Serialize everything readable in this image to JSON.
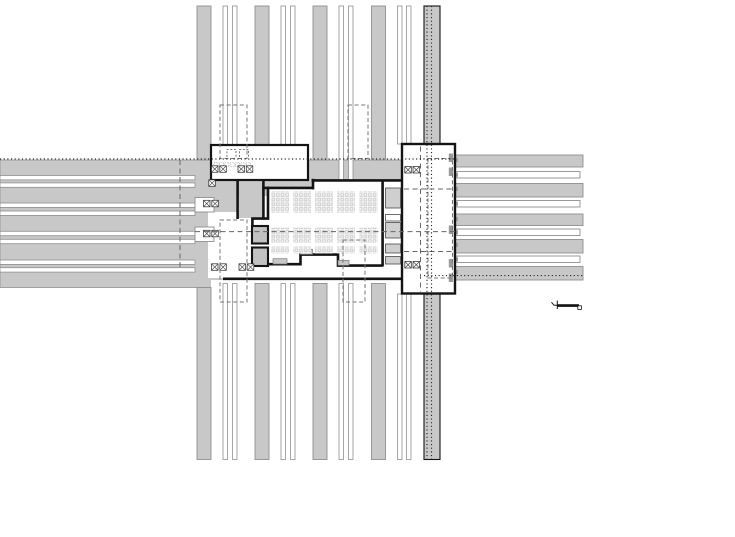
{
  "colors": {
    "road": "#c8c8c8",
    "edge": "#8f8f8f",
    "wall": "#141414",
    "dash": "#777777",
    "dot": "#262626",
    "shaft": "#c2c2c2",
    "paper": "#ffffff"
  },
  "plan": {
    "canvas": {
      "w": 735,
      "h": 537
    },
    "layers": [
      {
        "name": "horizontal-road-base",
        "cls": "flat",
        "rects": [
          [
            0,
            160,
            455,
            127.5
          ]
        ]
      },
      {
        "name": "under-building-clear",
        "cls": "white",
        "rects": [
          [
            211,
            280,
            244,
            8
          ]
        ]
      },
      {
        "name": "left-track-strips",
        "cls": "track",
        "rects": [
          [
            0,
            175.5,
            195,
            4.4
          ],
          [
            0,
            182.9,
            195,
            4.4
          ],
          [
            0,
            203,
            195,
            4.4
          ],
          [
            0,
            211,
            195,
            4.4
          ],
          [
            0,
            231.3,
            195,
            4.4
          ],
          [
            0,
            239.3,
            195,
            4.4
          ],
          [
            0,
            260,
            195,
            4.4
          ],
          [
            0,
            267.7,
            195,
            4.4
          ]
        ]
      },
      {
        "name": "right-road-bands",
        "cls": "road",
        "rects": [
          [
            455,
            155,
            128,
            12
          ],
          [
            455,
            183.5,
            128,
            13.5
          ],
          [
            455,
            214,
            128,
            11.5
          ],
          [
            455,
            239.5,
            128,
            13.5
          ],
          [
            455,
            266.5,
            128,
            13.5
          ]
        ]
      },
      {
        "name": "right-white-bars",
        "cls": "whitebar",
        "rects": [
          [
            457,
            171.5,
            123,
            6.5
          ],
          [
            457,
            200.5,
            123,
            6.5
          ],
          [
            457,
            229,
            123,
            6.5
          ],
          [
            457,
            256,
            123,
            6.5
          ]
        ]
      },
      {
        "name": "right-bar-ticks",
        "cls": "tick",
        "rects": [
          [
            455.8,
            173.2,
            2.2,
            3.2
          ],
          [
            455.8,
            202.2,
            2.2,
            3.2
          ],
          [
            455.8,
            230.7,
            2.2,
            3.2
          ],
          [
            455.8,
            257.7,
            2.2,
            3.2
          ],
          [
            456.2,
            158,
            1.6,
            4
          ],
          [
            456.2,
            187,
            1.6,
            4
          ],
          [
            456.2,
            217,
            1.6,
            4
          ],
          [
            456.2,
            243,
            1.6,
            4
          ],
          [
            456.2,
            270,
            1.6,
            4
          ]
        ]
      },
      {
        "name": "vertical-gray-bars-top",
        "cls": "road",
        "rects": [
          [
            197,
            6,
            14,
            154
          ],
          [
            255,
            6,
            14,
            154
          ],
          [
            313,
            6,
            14,
            154
          ],
          [
            371.5,
            6,
            14,
            154
          ]
        ]
      },
      {
        "name": "vertical-track-strips-top",
        "cls": "track",
        "rects": [
          [
            223,
            6,
            4.5,
            139
          ],
          [
            232.5,
            6,
            4.5,
            139
          ],
          [
            281,
            6,
            4.5,
            139
          ],
          [
            290.5,
            6,
            4.5,
            139
          ],
          [
            339,
            6,
            4.5,
            181
          ],
          [
            348.5,
            6,
            4.5,
            181
          ],
          [
            397.5,
            6,
            4.5,
            138
          ],
          [
            406.5,
            6,
            4.5,
            138
          ]
        ]
      },
      {
        "name": "vertical-gray-bars-bottom",
        "cls": "road",
        "rects": [
          [
            197,
            287.5,
            14,
            172
          ],
          [
            255,
            283.5,
            14,
            176
          ],
          [
            313,
            283.5,
            14,
            176
          ],
          [
            371.5,
            283.5,
            14,
            176
          ]
        ]
      },
      {
        "name": "vertical-track-strips-bottom",
        "cls": "track",
        "rects": [
          [
            223,
            283.5,
            4.5,
            176
          ],
          [
            232.5,
            283.5,
            4.5,
            176
          ],
          [
            281,
            283.5,
            4.5,
            176
          ],
          [
            290.5,
            283.5,
            4.5,
            176
          ],
          [
            339,
            283.5,
            4.5,
            176
          ],
          [
            348.5,
            283.5,
            4.5,
            176
          ],
          [
            397.5,
            294,
            4.5,
            165.5
          ],
          [
            406.5,
            294,
            4.5,
            165.5
          ]
        ]
      },
      {
        "name": "main-avenue-bar",
        "cls": "bigbar",
        "rects": [
          [
            424,
            6,
            16,
            138
          ],
          [
            424,
            294,
            16,
            165.5
          ]
        ]
      },
      {
        "name": "plaza-white",
        "cls": "white",
        "rects": [
          [
            208,
            212,
            60,
            66
          ],
          [
            238,
            196,
            30,
            22
          ]
        ]
      },
      {
        "name": "concourse-hall-floor",
        "paths": [
          [
            "M268,189 H313 V180 H402 V278 H268 Z",
            "white"
          ]
        ]
      },
      {
        "name": "corridor-gray",
        "cls": "flat2",
        "rects": [
          [
            239,
            180,
            23,
            38
          ]
        ]
      },
      {
        "name": "north-pavilion",
        "cls": "building",
        "rects": [
          [
            211,
            145,
            97,
            35
          ]
        ]
      },
      {
        "name": "east-wing",
        "cls": "building2",
        "rects": [
          [
            402,
            144,
            53,
            149.5
          ]
        ]
      },
      {
        "name": "walls",
        "paths": [
          [
            "M237.6,180 V219",
            "wall"
          ],
          [
            "M263.4,180 V219",
            "wall"
          ],
          [
            "M262,187.9 H313.5",
            "wall",
            3
          ],
          [
            "M311.5,180.4 H402",
            "wall",
            3
          ],
          [
            "M313,178.8 V189.4",
            "wall",
            2.8
          ],
          [
            "M382.6,180.5 V266.5",
            "wall",
            2.8
          ],
          [
            "M252,264.2 H300.5 V254.6 H338 V265.6 H382.6",
            "wall"
          ],
          [
            "M223,278.8 H402",
            "wall",
            3.2
          ],
          [
            "M268,186.5 V218.6 H252.4 V227.5",
            "wall"
          ]
        ]
      },
      {
        "name": "elevator-shafts",
        "cls": "shaft",
        "rects": [
          [
            252,
            226,
            16,
            17.5
          ],
          [
            252,
            247.5,
            16,
            18.5
          ]
        ]
      },
      {
        "name": "service-boxes",
        "rects": [
          [
            385.5,
            188,
            15,
            20,
            "box"
          ],
          [
            385.5,
            214.5,
            15,
            6.5,
            "boxw"
          ],
          [
            385.5,
            222.5,
            15,
            15.5,
            "box"
          ],
          [
            385.5,
            244,
            15,
            9,
            "box"
          ],
          [
            385.5,
            256.5,
            15,
            7.5,
            "box"
          ]
        ]
      },
      {
        "name": "platform-stubs",
        "cls": "graybit",
        "rects": [
          [
            273,
            258.7,
            14,
            5.3
          ],
          [
            300.5,
            249.3,
            12,
            5
          ],
          [
            338,
            260.3,
            11,
            5
          ],
          [
            368,
            193.8,
            8,
            6
          ]
        ]
      },
      {
        "name": "track-stubs-left",
        "cls": "whitebar",
        "rects": [
          [
            195,
            197.5,
            19,
            14.5
          ],
          [
            195,
            227,
            19,
            14.5
          ]
        ]
      },
      {
        "name": "wing-interior",
        "paths": [
          [
            "M428,158.5 h24.5 v119.5 h-24.5 Z",
            "dash"
          ],
          [
            "M420.5,146.5 V291.5",
            "dashL"
          ],
          [
            "M404,189 H453",
            "dashL"
          ],
          [
            "M404,251.5 H453",
            "dashL"
          ]
        ],
        "rects": [
          [
            448.8,
            153.5,
            4.2,
            8.5,
            "tick"
          ],
          [
            448.8,
            167.5,
            4.2,
            8.5,
            "tick"
          ],
          [
            448.8,
            225.5,
            4.2,
            8.5,
            "tick"
          ],
          [
            448.8,
            259,
            4.2,
            8.5,
            "tick"
          ],
          [
            448.8,
            273.5,
            4.2,
            8.5,
            "tick"
          ]
        ]
      },
      {
        "name": "pavilion-furniture",
        "paths": [
          [
            "M227,157 v-7.5 h9 v7.5",
            "dashS"
          ],
          [
            "M239.5,157 v-7.5 h9 v7.5",
            "dashS"
          ]
        ],
        "rects": [
          [
            214,
            162.8,
            4,
            4,
            "dotS"
          ],
          [
            219.4,
            162.8,
            4,
            4,
            "dotS"
          ],
          [
            224.8,
            162.8,
            4,
            4,
            "dotS"
          ],
          [
            230.2,
            162.8,
            4,
            4,
            "dotS"
          ],
          [
            235.6,
            162.8,
            4,
            4,
            "dotS"
          ],
          [
            241,
            162.8,
            4,
            4,
            "dotS"
          ],
          [
            246.4,
            162.8,
            4,
            4,
            "dotS"
          ]
        ]
      },
      {
        "name": "seating-blocks",
        "type": "seats",
        "w": 18,
        "xs": [
          271,
          293,
          315,
          337,
          359.5
        ],
        "bands": [
          {
            "y": 191.5,
            "h": 21
          },
          {
            "y": 227.5,
            "h": 15
          },
          {
            "y": 246.5,
            "h": 7
          }
        ]
      },
      {
        "name": "column-symbols",
        "type": "xsq",
        "s": 6.5,
        "pts": [
          [
            211.5,
            165.8
          ],
          [
            219.8,
            165.8
          ],
          [
            238,
            165.8
          ],
          [
            246.3,
            165.8
          ],
          [
            208.8,
            179.8
          ],
          [
            203.5,
            200.3
          ],
          [
            211.8,
            200.3
          ],
          [
            203.5,
            230.3
          ],
          [
            211.8,
            230.3
          ],
          [
            211.5,
            263.8
          ],
          [
            219.8,
            263.8
          ],
          [
            239,
            263.8
          ],
          [
            247.3,
            263.8
          ],
          [
            404.8,
            166.5
          ],
          [
            413,
            166.5
          ],
          [
            404.8,
            261.5
          ],
          [
            413,
            261.5
          ]
        ]
      },
      {
        "name": "escalator-outlines",
        "cls": "dash",
        "rects": [
          [
            220,
            105,
            27,
            53.5
          ],
          [
            348,
            105,
            20,
            53.5
          ],
          [
            220,
            220,
            27,
            82
          ],
          [
            343,
            240,
            22,
            62
          ]
        ]
      },
      {
        "name": "section-dashed-lines",
        "paths": [
          [
            "M195,231.6 H455",
            "dashL"
          ],
          [
            "M180,160 V269",
            "dashL"
          ]
        ]
      },
      {
        "name": "boundary-dotted-lines",
        "paths": [
          [
            "M0,159 H455",
            "dot"
          ],
          [
            "M424,275.6 H583",
            "dot"
          ],
          [
            "M427,6 V459.5",
            "dot"
          ],
          [
            "M431.5,6 V459.5",
            "dot"
          ]
        ]
      },
      {
        "name": "scale-figure",
        "paths": [
          [
            "M551.5,302.3 l2.6,3 M554.1,305.3 l3.5,0",
            "figS"
          ],
          [
            "M557.3,300.6 V309",
            "figS"
          ]
        ],
        "rects": [
          [
            557.5,
            304.2,
            21.5,
            2.7,
            "figbar"
          ],
          [
            577.8,
            305.8,
            3.6,
            3.6,
            "figsq"
          ]
        ]
      }
    ]
  }
}
